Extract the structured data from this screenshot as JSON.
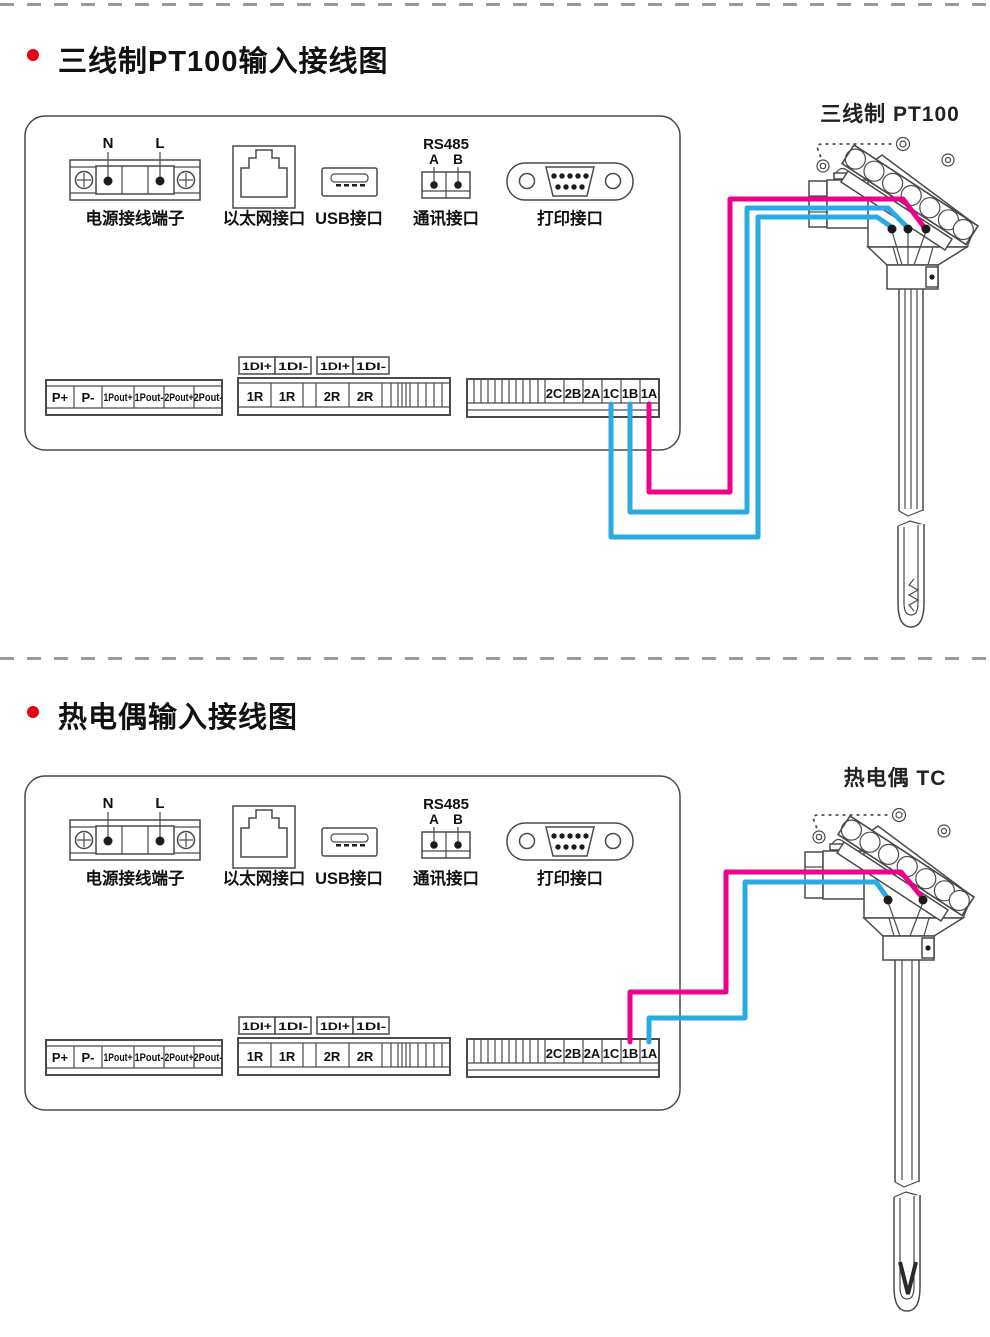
{
  "page": {
    "title1": "三线制PT100输入接线图",
    "title2": "热电偶输入接线图"
  },
  "panel": {
    "power_n": "N",
    "power_l": "L",
    "power_label": "电源接线端子",
    "ethernet_label": "以太网接口",
    "usb_label": "USB接口",
    "comm_protocol": "RS485",
    "comm_a": "A",
    "comm_b": "B",
    "comm_label": "通讯接口",
    "print_label": "打印接口"
  },
  "terminals": {
    "left": [
      "P+",
      "P-",
      "1Pout+",
      "1Pout-",
      "2Pout+",
      "2Pout-"
    ],
    "di_labels": [
      "1DI+",
      "1DI-",
      "1DI+",
      "1DI-"
    ],
    "middle": [
      "1R",
      "1R",
      "2R",
      "2R"
    ],
    "right": [
      "2C",
      "2B",
      "2A",
      "1C",
      "1B",
      "1A"
    ]
  },
  "sensor1": {
    "label": "三线制 PT100"
  },
  "sensor2": {
    "label": "热电偶 TC"
  },
  "wiring1": {
    "wires": [
      {
        "from": "1A",
        "color_key": "wire_pink"
      },
      {
        "from": "1B",
        "color_key": "wire_blue"
      },
      {
        "from": "1C",
        "color_key": "wire_blue"
      }
    ]
  },
  "wiring2": {
    "wires": [
      {
        "from": "1B",
        "color_key": "wire_pink"
      },
      {
        "from": "1A",
        "color_key": "wire_blue"
      }
    ]
  },
  "colors": {
    "wire_pink": "#ec008c",
    "wire_blue": "#29abe2",
    "accent_red": "#e60012",
    "diagram_line": "#4a4a4a"
  }
}
